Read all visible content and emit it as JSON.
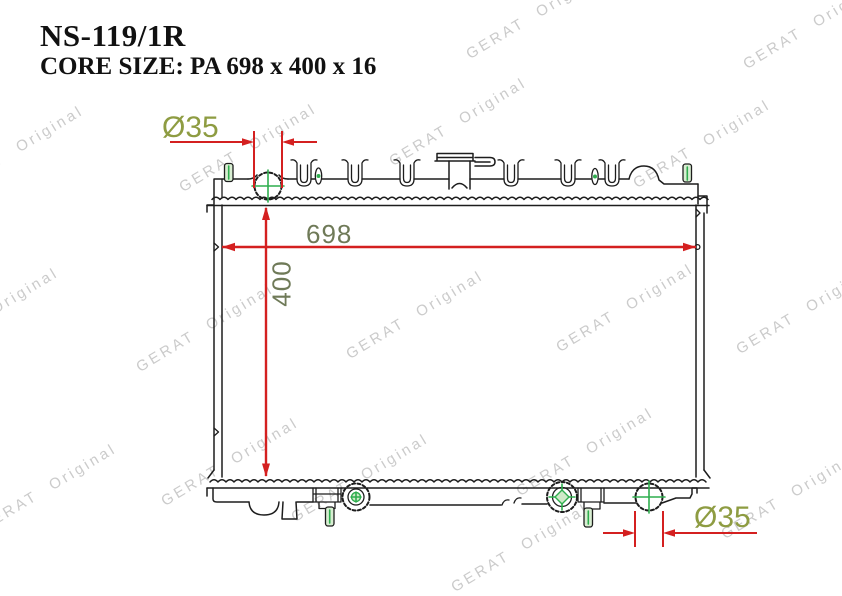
{
  "header": {
    "part_number": "NS-119/1R",
    "core_size": "CORE SIZE: PA 698 x 400 x 16"
  },
  "dimensions": {
    "inlet_diameter_label": "Ø35",
    "outlet_diameter_label": "Ø35",
    "core_width_label": "698",
    "core_height_label": "400"
  },
  "watermark_text": "GERAT Original",
  "colors": {
    "dimension_line_red": "#d42020",
    "diameter_label_olive": "#8e9c42",
    "size_label_olive": "#6f7a58",
    "center_mark_green": "#2fae4e",
    "line_black": "#1d1d1d",
    "watermark_gray": "#cbcbcb"
  }
}
